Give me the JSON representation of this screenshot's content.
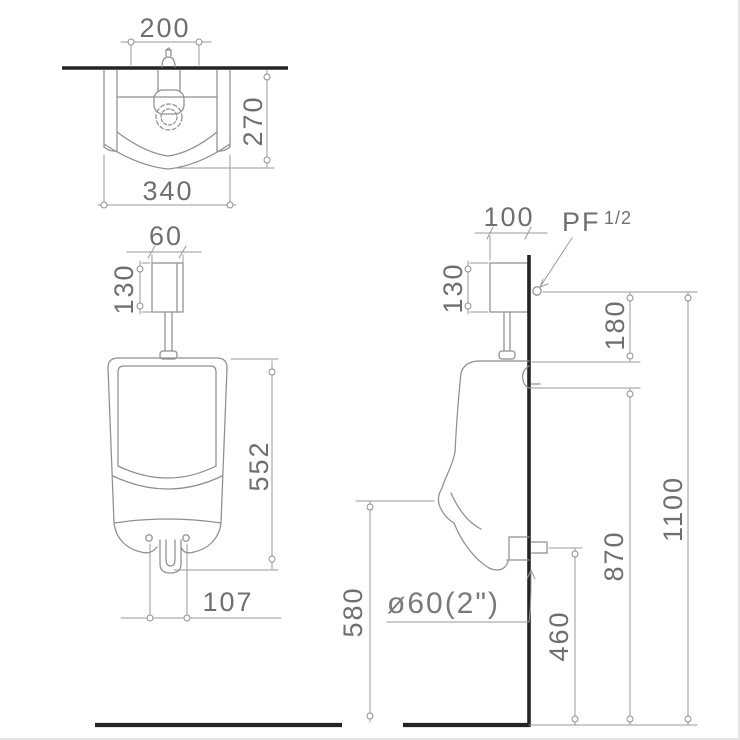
{
  "drawing": {
    "description": "urinal installation dimension drawing, three orthographic views",
    "colors": {
      "background": "#ffffff",
      "thin_line": "#8f8f8f",
      "text": "#6f6f6f",
      "heavy_line": "#242424"
    },
    "top_view": {
      "inlet_center": "200",
      "depth": "270",
      "width": "340"
    },
    "front_view": {
      "valve_width": "60",
      "valve_height": "130",
      "body_height": "552",
      "bolt_spacing": "107"
    },
    "side_view": {
      "valve_depth": "100",
      "supply_label": "PF",
      "supply_size": "1/2",
      "valve_height": "130",
      "supply_to_rim": "180",
      "hanger_height": "870",
      "supply_height": "1100",
      "outlet_height": "460",
      "rim_bottom_height": "580",
      "outlet_size": "ø60(2\")"
    }
  }
}
